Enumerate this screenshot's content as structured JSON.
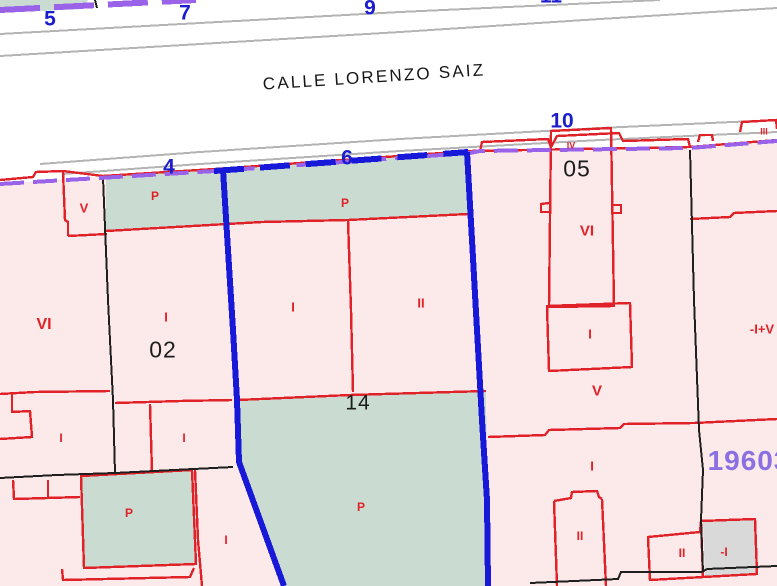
{
  "street": {
    "name": "CALLE LORENZO SAIZ"
  },
  "house_numbers": {
    "n5": "5",
    "n7": "7",
    "n9": "9",
    "n11": "11",
    "n10": "10",
    "n4": "4",
    "n6": "6"
  },
  "parcels": {
    "p02": "02",
    "p05": "05",
    "p14": "14"
  },
  "floors": {
    "vi_left": "VI",
    "i_02": "I",
    "i_mid": "I",
    "ii_mid": "II",
    "v_small": "V",
    "vi_bldg": "VI",
    "i_bldg": "I",
    "v_05": "V",
    "i_right": "I",
    "combo_right": "-I+V",
    "ii_bottom": "II",
    "ii_corner": "II",
    "minus_i": "-I",
    "i_a": "I",
    "i_b": "I",
    "i_c": "I",
    "i_d": "I",
    "iv_top": "IV",
    "iii_top": "III"
  },
  "patios": {
    "p_left": "P",
    "p_right": "P",
    "p_sq": "P",
    "p_14": "P"
  },
  "block_number": "19603",
  "colors": {
    "parcel_fill": "#fce9ea",
    "patio_fill": "#cadcd2",
    "building_gray": "#d9d9d9",
    "boundary_purple": "#9a62e8",
    "boundary_blue": "#1818d8",
    "line_red": "#e02228",
    "line_black": "#1f1f1f",
    "street_gray": "#b4b4b4",
    "number_blue": "#1c1ccf",
    "label_red": "#e02228",
    "block_purple": "#8a70e0"
  }
}
